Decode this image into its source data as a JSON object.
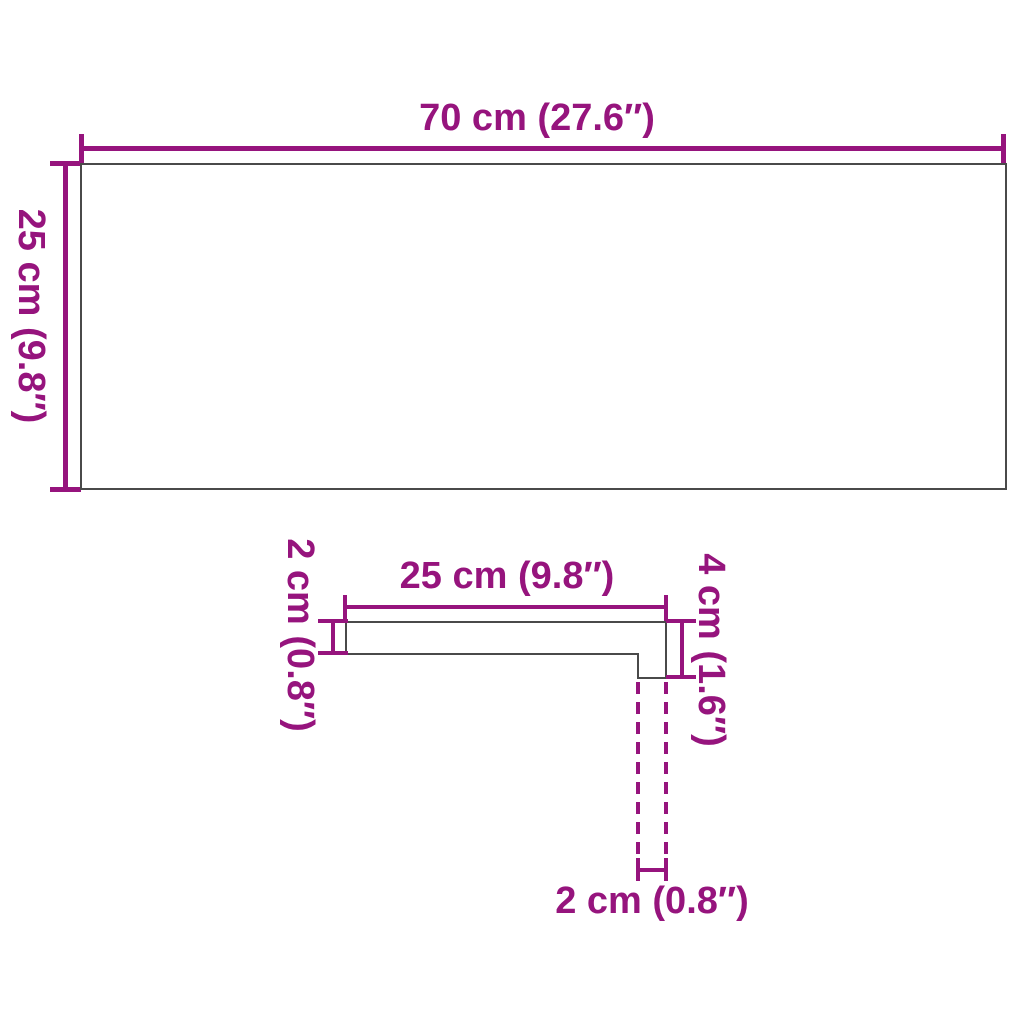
{
  "colors": {
    "accent": "#96147d",
    "outline": "#4a4a4a",
    "background": "#ffffff"
  },
  "diagram": {
    "type": "product-dimension-drawing",
    "views": {
      "top_view": {
        "width": {
          "label": "70 cm (27.6″)",
          "cm": 70,
          "inches": 27.6
        },
        "depth": {
          "label": "25 cm (9.8″)",
          "cm": 25,
          "inches": 9.8
        }
      },
      "profile_view": {
        "tread_depth": {
          "label": "25 cm (9.8″)",
          "cm": 25,
          "inches": 9.8
        },
        "board_thickness": {
          "label": "2 cm (0.8″)",
          "cm": 2,
          "inches": 0.8
        },
        "nose_height": {
          "label": "4 cm (1.6″)",
          "cm": 4,
          "inches": 1.6
        },
        "nose_thickness": {
          "label": "2 cm (0.8″)",
          "cm": 2,
          "inches": 0.8
        }
      }
    }
  }
}
